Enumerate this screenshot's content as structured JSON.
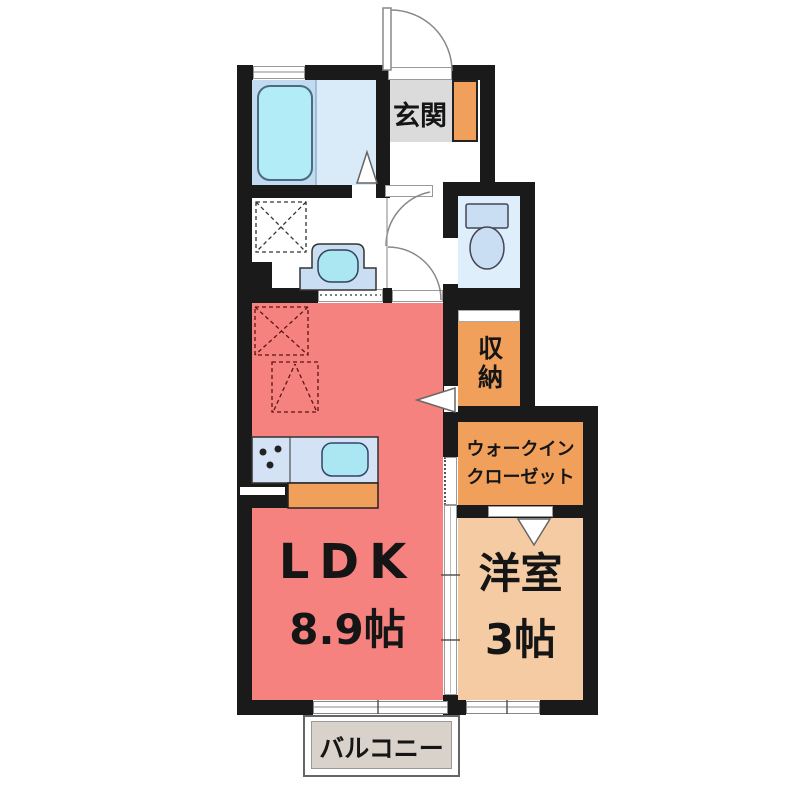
{
  "type": "floor-plan",
  "rooms": {
    "entrance": {
      "label": "玄関"
    },
    "storage": {
      "label": "収納"
    },
    "walk_in_closet": {
      "label_line1": "ウォークイン",
      "label_line2": "クローゼット"
    },
    "ldk": {
      "label": "LDK",
      "size": "8.9帖"
    },
    "western_room": {
      "label": "洋室",
      "size": "3帖"
    },
    "balcony": {
      "label": "バルコニー"
    }
  },
  "fixtures": [
    "bathtub",
    "washbasin",
    "toilet",
    "washing-machine-space",
    "refrigerator-space",
    "appliance-space",
    "kitchen-counter",
    "kitchen-sink",
    "stove-burners",
    "kitchen-cabinet",
    "shoe-cabinet",
    "entrance-door",
    "interior-door-arc",
    "sliding-door",
    "folding-door",
    "window"
  ],
  "colors": {
    "wall": "#1a1a1a",
    "ldk_fill": "#F5827E",
    "closet_fill": "#F0A05A",
    "western_room_fill": "#F5CBA4",
    "bathroom_floor": "#D9EAF8",
    "tub_panel": "#C2DBF0",
    "tub_fill": "#B2ECF6",
    "fixture_fill": "#C9DEF2",
    "sink_fill": "#ABE7F3",
    "toilet_floor": "#DFEEFB",
    "counter_fill": "#D3E2F4",
    "genkan_tile": "#DBDBDB",
    "balcony_fill": "#D8D2CA"
  }
}
